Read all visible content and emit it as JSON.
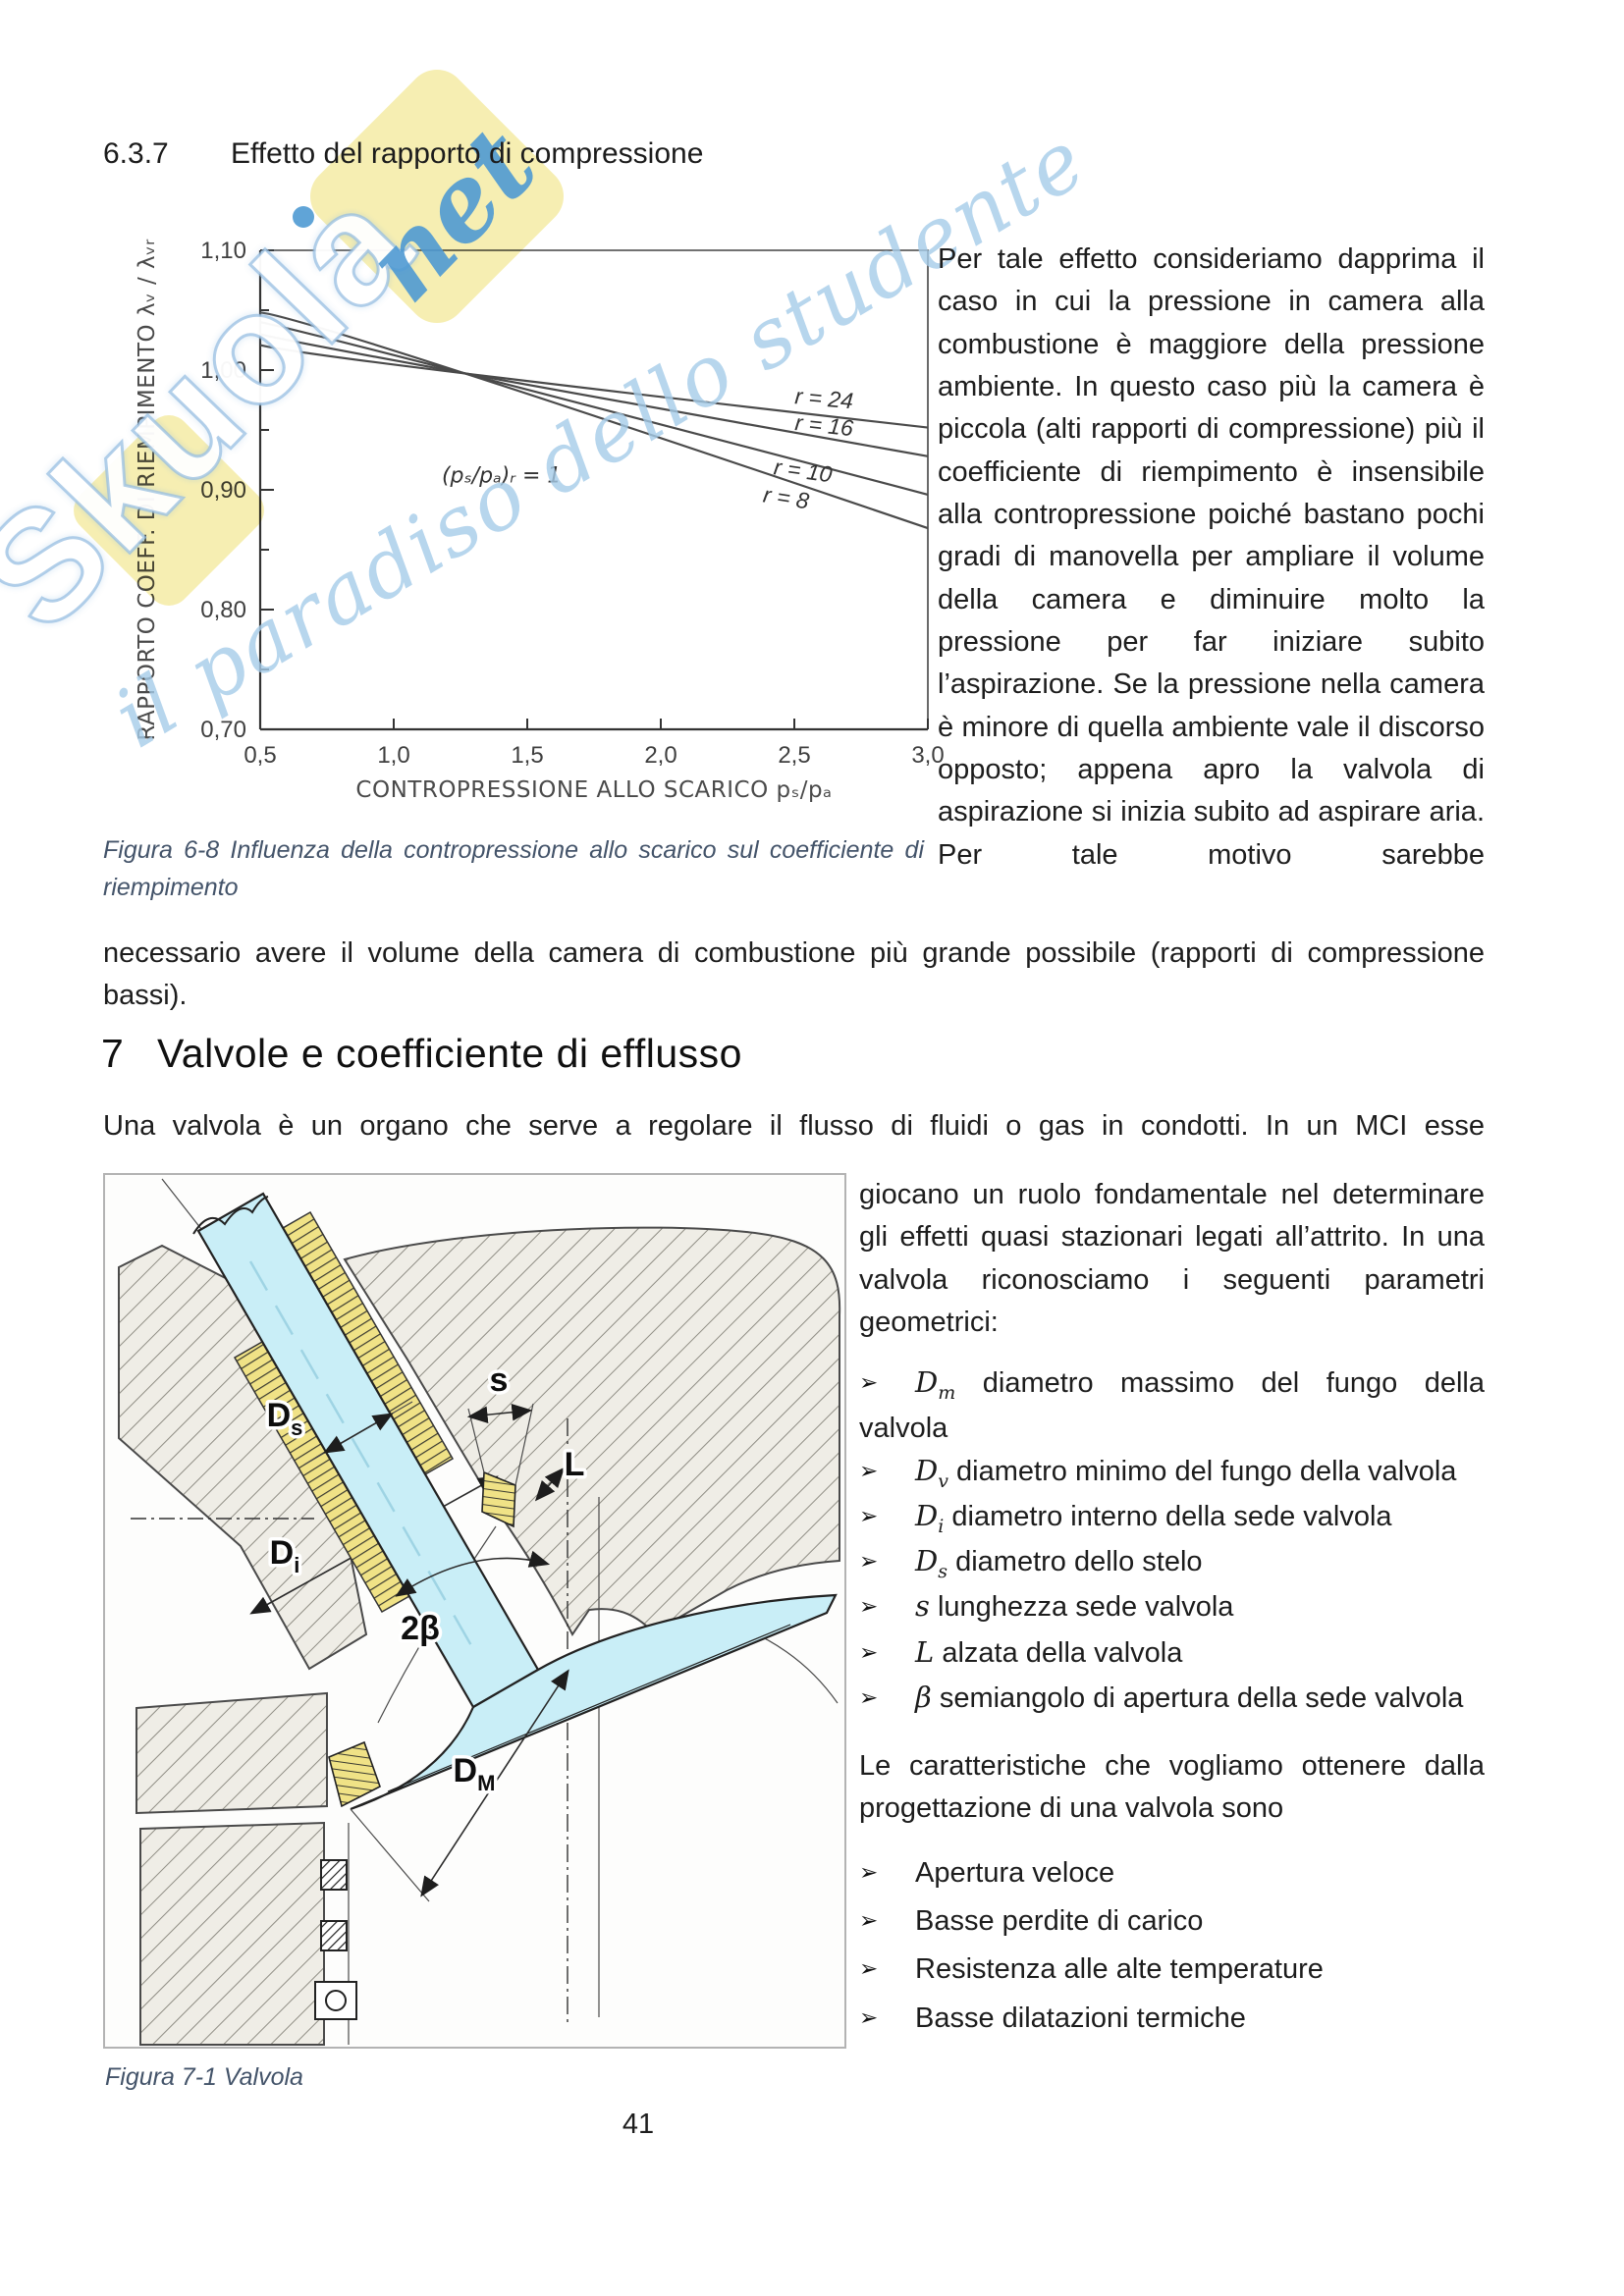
{
  "page": {
    "number": "41"
  },
  "section637": {
    "number": "6.3.7",
    "title": "Effetto del rapporto di compressione",
    "paragraph_right": "Per tale effetto consideriamo dapprima il caso in cui la pressione in camera alla combustione è maggiore della pressione ambiente. In questo caso più la camera è piccola (alti rapporti di compressione) più il coefficiente di riempimento è insensibile alla contropressione poiché bastano pochi gradi di manovella per ampliare il volume della camera e diminuire molto la pressione per far iniziare subito l’aspirazione. Se la pressione nella camera è minore di quella ambiente vale il discorso opposto; appena apro la valvola di aspirazione si inizia subito ad aspirare aria. Per tale motivo sarebbe",
    "paragraph_continuation": "necessario avere il volume della camera di combustione più grande possibile (rapporti di compressione bassi).",
    "figure_caption": "Figura 6-8 Influenza della contropressione allo scarico sul coefficiente di riempimento"
  },
  "chart_data": {
    "type": "line",
    "title": "",
    "xlabel": "CONTROPRESSIONE ALLO SCARICO  pₛ/pₐ",
    "ylabel": "RAPPORTO COEFF. DI RIEMPIMENTO  λᵥ / λᵥᵣ",
    "xlim": [
      0.5,
      3.0
    ],
    "ylim": [
      0.7,
      1.1
    ],
    "grid": false,
    "legend_position": "inline-labels",
    "xticks": [
      {
        "v": 0.5,
        "label": "0,5"
      },
      {
        "v": 1.0,
        "label": "1,0"
      },
      {
        "v": 1.5,
        "label": "1,5"
      },
      {
        "v": 2.0,
        "label": "2,0"
      },
      {
        "v": 2.5,
        "label": "2,5"
      },
      {
        "v": 3.0,
        "label": "3,0"
      }
    ],
    "yticks": [
      {
        "v": 0.7,
        "label": "0,70"
      },
      {
        "v": 0.75,
        "label": ""
      },
      {
        "v": 0.8,
        "label": "0,80"
      },
      {
        "v": 0.85,
        "label": ""
      },
      {
        "v": 0.9,
        "label": "0,90"
      },
      {
        "v": 0.95,
        "label": ""
      },
      {
        "v": 1.0,
        "label": "1,00"
      },
      {
        "v": 1.05,
        "label": ""
      },
      {
        "v": 1.1,
        "label": "1,10"
      }
    ],
    "annotation": {
      "text": "(pₛ/pₐ)ᵣ = 1",
      "x": 1.18,
      "y": 0.906
    },
    "series": [
      {
        "name": "r = 24",
        "points": [
          [
            0.5,
            1.021
          ],
          [
            1.2,
            0.999
          ],
          [
            3.0,
            0.952
          ]
        ],
        "label_pos": [
          2.5,
          0.972
        ],
        "label_rot": 5
      },
      {
        "name": "r = 16",
        "points": [
          [
            0.5,
            1.03
          ],
          [
            1.2,
            1.0
          ],
          [
            3.0,
            0.928
          ]
        ],
        "label_pos": [
          2.5,
          0.95
        ],
        "label_rot": 6
      },
      {
        "name": "r = 10",
        "points": [
          [
            0.5,
            1.04
          ],
          [
            1.2,
            1.001
          ],
          [
            3.0,
            0.896
          ]
        ],
        "label_pos": [
          2.42,
          0.913
        ],
        "label_rot": 8
      },
      {
        "name": "r = 8",
        "points": [
          [
            0.5,
            1.048
          ],
          [
            1.2,
            1.002
          ],
          [
            3.0,
            0.868
          ]
        ],
        "label_pos": [
          2.38,
          0.89
        ],
        "label_rot": 9
      }
    ]
  },
  "section7": {
    "number": "7",
    "title": "Valvole e coefficiente di efflusso",
    "intro": "Una valvola è un organo che serve a regolare il flusso di fluidi o gas in condotti. In un MCI esse",
    "paragraph_right": "giocano un ruolo fondamentale nel determinare gli effetti quasi stazionari legati all’attrito. In una valvola riconosciamo i seguenti parametri geometrici:",
    "bullet_marker": "➢",
    "parameters": [
      {
        "sym": "D",
        "sub": "m",
        "text": "diametro massimo del fungo della valvola"
      },
      {
        "sym": "D",
        "sub": "v",
        "text": "diametro minimo del fungo della valvola"
      },
      {
        "sym": "D",
        "sub": "i",
        "text": "diametro interno della sede valvola"
      },
      {
        "sym": "D",
        "sub": "s",
        "text": "diametro dello stelo"
      },
      {
        "sym": "s",
        "sub": "",
        "text": "lunghezza sede valvola"
      },
      {
        "sym": "L",
        "sub": "",
        "text": "alzata della valvola"
      },
      {
        "sym": "β",
        "sub": "",
        "text": "semiangolo di apertura della sede valvola"
      }
    ],
    "characteristics_intro": "Le caratteristiche che vogliamo ottenere dalla progettazione di una valvola sono",
    "characteristics": [
      "Apertura veloce",
      "Basse perdite di carico",
      "Resistenza alle alte temperature",
      "Basse dilatazioni termiche"
    ],
    "figure_caption": "Figura 7-1 Valvola"
  },
  "valve_figure": {
    "labels": {
      "ds": {
        "main": "D",
        "sub": "s"
      },
      "di": {
        "main": "D",
        "sub": "i"
      },
      "two_beta": {
        "main": "2β",
        "sub": ""
      },
      "dm": {
        "main": "D",
        "sub": "M"
      },
      "s": {
        "main": "s",
        "sub": ""
      },
      "l": {
        "main": "L",
        "sub": ""
      }
    },
    "valve_color": "#c9eef7",
    "guide_color": "#f0e286"
  },
  "watermark": {
    "brand": "Skuola",
    "tld": "net",
    "tagline": "il paradiso dello studente",
    "blue": "#4f9ad3",
    "yellow": "#f5eca7"
  }
}
